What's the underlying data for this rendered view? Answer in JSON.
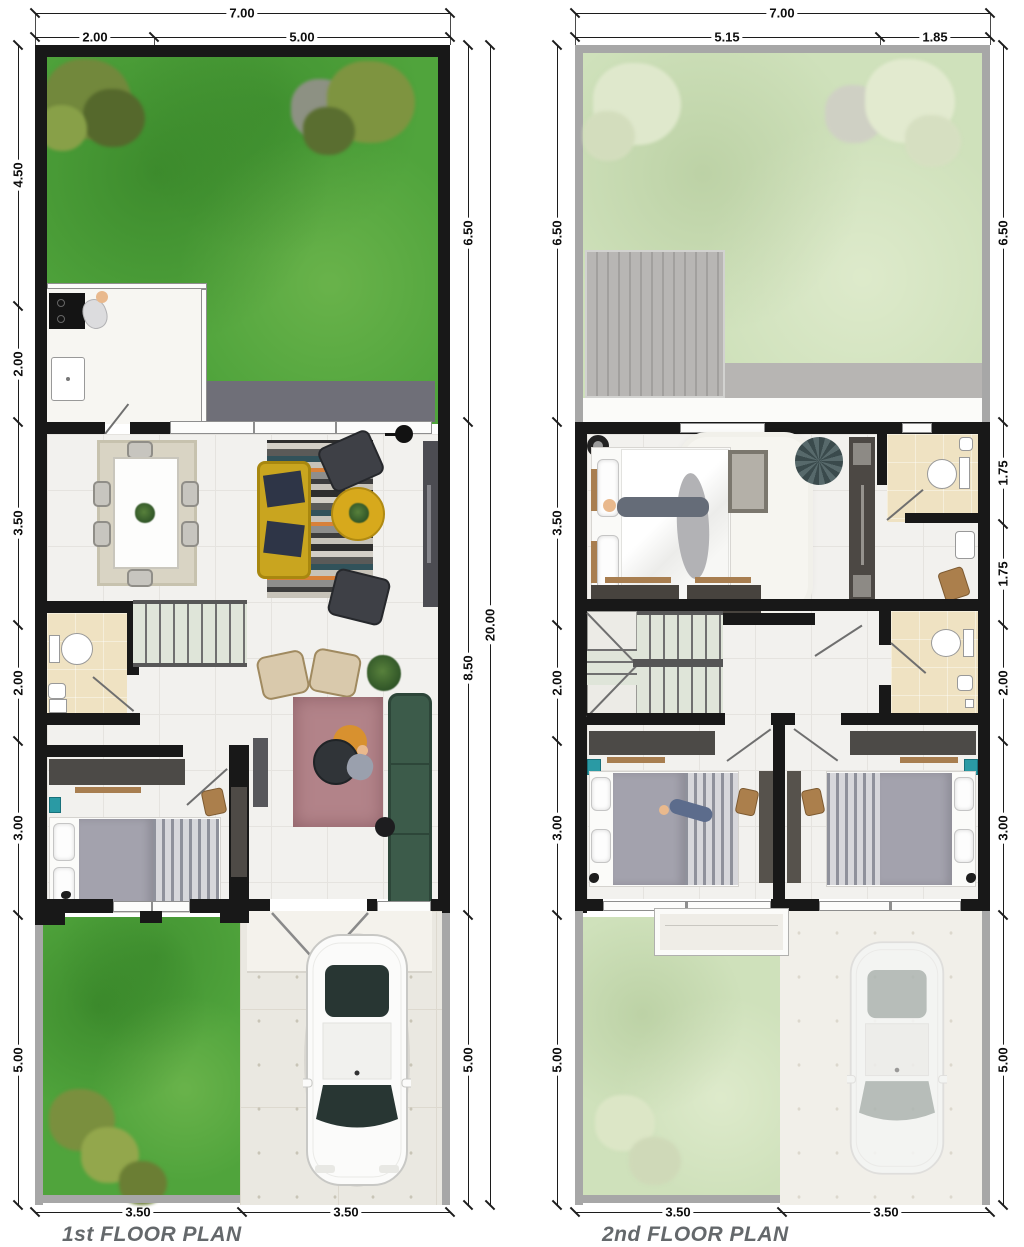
{
  "titles": {
    "plan1": "1st FLOOR PLAN",
    "plan2": "2nd FLOOR PLAN"
  },
  "dims": {
    "plan1": {
      "top_total": "7.00",
      "top_segments": [
        "2.00",
        "5.00"
      ],
      "left": [
        "4.50",
        "2.00",
        "3.50",
        "2.00",
        "3.00",
        "5.00"
      ],
      "right_inner": [
        "6.50",
        "8.50",
        "5.00"
      ],
      "right_total": "20.00",
      "bottom": [
        "3.50",
        "3.50"
      ]
    },
    "plan2": {
      "top_total": "7.00",
      "top_segments": [
        "5.15",
        "1.85"
      ],
      "left": [
        "6.50",
        "3.50",
        "2.00",
        "3.00",
        "5.00"
      ],
      "right": [
        "6.50",
        "1.75",
        "1.75",
        "2.00",
        "3.00",
        "5.00"
      ],
      "bottom": [
        "3.50",
        "3.50"
      ]
    }
  },
  "colors": {
    "wall": "#181818",
    "boundary_wall": "#a7a7a7",
    "lawn": "#50a43c",
    "lawn_faded": "#cfe1bb",
    "bathroom_floor": "#efe2c2",
    "terrace": "#6f6f78",
    "sofa_yellow": "#c9a51f",
    "sofa_green": "#3c5b4a",
    "rug_mauve": "#b28389",
    "rug_dining": "#d9d4c4",
    "car_body": "#fbfbfa",
    "dimension_text": "#0e0e0e",
    "title_text": "#64686b"
  }
}
